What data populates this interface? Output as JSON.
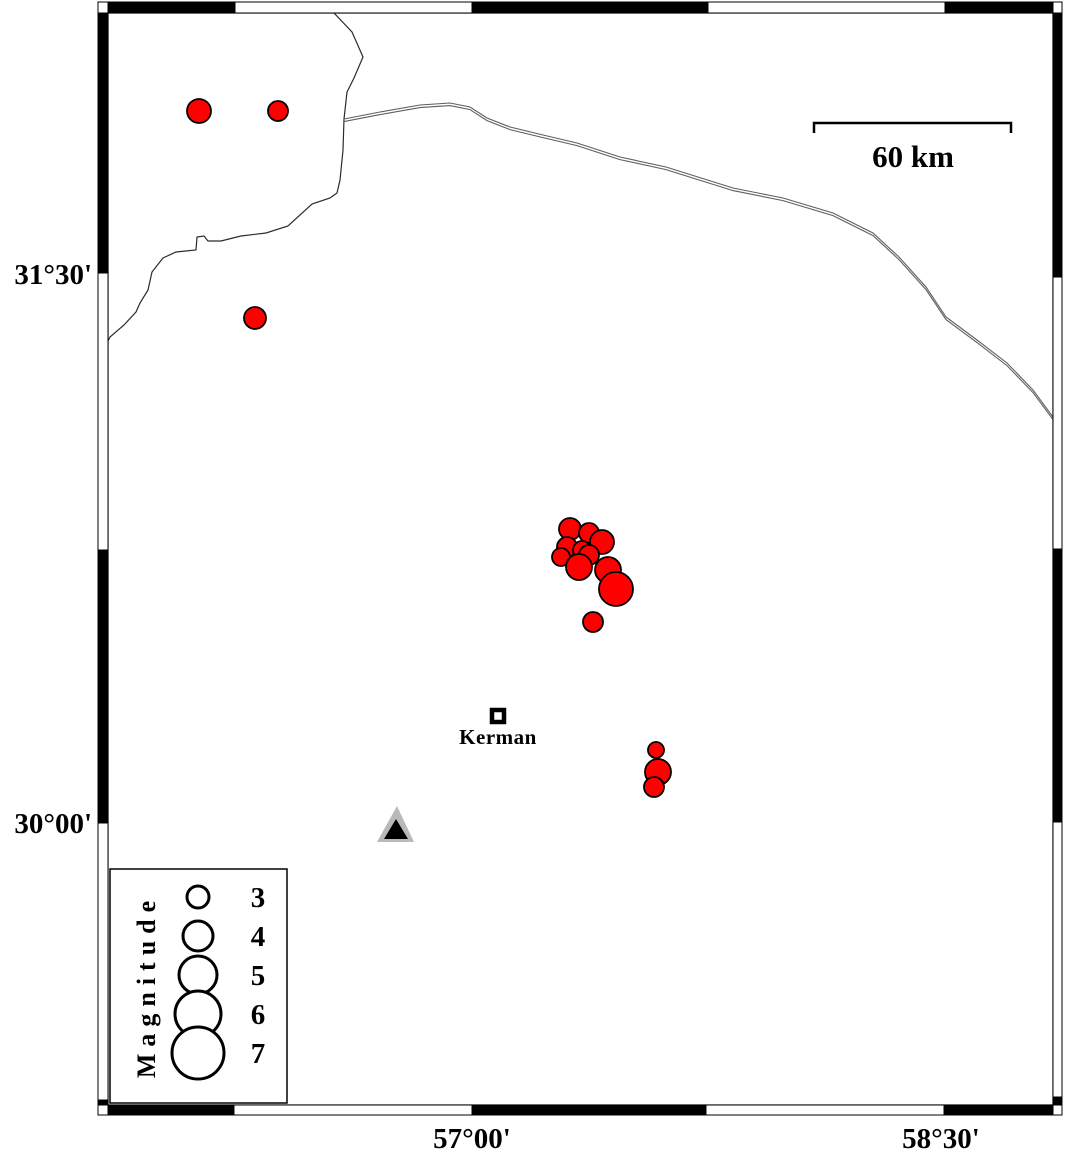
{
  "figure": {
    "width": 1066,
    "height": 1154,
    "background": "#ffffff"
  },
  "map_frame": {
    "inner": {
      "x": 108,
      "y": 13,
      "w": 945,
      "h": 1092
    },
    "bar_thickness": 10,
    "segments": {
      "top": [
        {
          "from": 108,
          "to": 235,
          "color": "black"
        },
        {
          "from": 235,
          "to": 472,
          "color": "white"
        },
        {
          "from": 472,
          "to": 708,
          "color": "black"
        },
        {
          "from": 708,
          "to": 945,
          "color": "white"
        },
        {
          "from": 945,
          "to": 1053,
          "color": "black"
        }
      ],
      "bottom": [
        {
          "from": 108,
          "to": 234,
          "color": "black"
        },
        {
          "from": 234,
          "to": 472,
          "color": "white"
        },
        {
          "from": 472,
          "to": 706,
          "color": "black"
        },
        {
          "from": 706,
          "to": 944,
          "color": "white"
        },
        {
          "from": 944,
          "to": 1053,
          "color": "black"
        }
      ],
      "left": [
        {
          "from": 13,
          "to": 273,
          "color": "black"
        },
        {
          "from": 273,
          "to": 550,
          "color": "white"
        },
        {
          "from": 550,
          "to": 823,
          "color": "black"
        },
        {
          "from": 823,
          "to": 1100,
          "color": "white"
        },
        {
          "from": 1100,
          "to": 1105,
          "color": "black"
        }
      ],
      "right": [
        {
          "from": 13,
          "to": 277,
          "color": "black"
        },
        {
          "from": 277,
          "to": 549,
          "color": "white"
        },
        {
          "from": 549,
          "to": 822,
          "color": "black"
        },
        {
          "from": 822,
          "to": 1097,
          "color": "white"
        },
        {
          "from": 1097,
          "to": 1105,
          "color": "black"
        }
      ]
    }
  },
  "axis_labels": {
    "left": [
      {
        "text": "31°30'",
        "y": 273
      },
      {
        "text": "30°00'",
        "y": 822
      }
    ],
    "bottom": [
      {
        "text": "57°00'",
        "x": 472
      },
      {
        "text": "58°30'",
        "x": 941
      }
    ]
  },
  "scale_bar": {
    "label": "60 km",
    "x1": 814,
    "x2": 1011,
    "y": 123,
    "tick_drop": 10,
    "label_x": 913,
    "label_y": 167
  },
  "city": {
    "name": "Kerman",
    "marker_x": 498,
    "marker_y": 716,
    "label_x": 498,
    "label_y": 744
  },
  "station": {
    "outer_color": "#b9b9b9",
    "inner_color": "#000000",
    "outer": [
      [
        397,
        806
      ],
      [
        377,
        842
      ],
      [
        414,
        842
      ]
    ],
    "inner": [
      [
        396,
        819
      ],
      [
        384,
        839
      ],
      [
        408,
        839
      ]
    ]
  },
  "basemap_lines": {
    "border_color": "#2b2b2b",
    "road_color": "#5f5f5f",
    "border": [
      [
        334,
        13
      ],
      [
        352,
        32
      ],
      [
        363,
        57
      ],
      [
        354,
        78
      ],
      [
        347,
        92
      ],
      [
        344,
        119
      ],
      [
        343,
        150
      ],
      [
        340,
        180
      ],
      [
        337,
        193
      ],
      [
        330,
        198
      ],
      [
        312,
        204
      ],
      [
        288,
        226
      ],
      [
        266,
        233
      ],
      [
        241,
        236
      ],
      [
        221,
        241
      ],
      [
        208,
        241
      ],
      [
        204,
        236
      ],
      [
        197,
        237
      ],
      [
        196,
        250
      ],
      [
        176,
        252
      ],
      [
        163,
        258
      ],
      [
        152,
        272
      ],
      [
        148,
        290
      ],
      [
        140,
        303
      ],
      [
        136,
        312
      ],
      [
        124,
        325
      ],
      [
        110,
        337
      ],
      [
        108,
        341
      ]
    ],
    "road": [
      [
        344,
        119
      ],
      [
        380,
        112
      ],
      [
        420,
        105
      ],
      [
        450,
        103
      ],
      [
        470,
        107
      ],
      [
        487,
        118
      ],
      [
        510,
        127
      ],
      [
        543,
        135
      ],
      [
        577,
        143
      ],
      [
        620,
        157
      ],
      [
        666,
        167
      ],
      [
        733,
        188
      ],
      [
        783,
        198
      ],
      [
        833,
        213
      ],
      [
        873,
        233
      ],
      [
        899,
        257
      ],
      [
        926,
        287
      ],
      [
        946,
        317
      ],
      [
        977,
        340
      ],
      [
        1007,
        363
      ],
      [
        1033,
        390
      ],
      [
        1053,
        417
      ]
    ]
  },
  "earthquakes": {
    "fill": "#ff0000",
    "stroke": "#000000",
    "points": [
      {
        "x": 199,
        "y": 111,
        "r": 12
      },
      {
        "x": 278,
        "y": 111,
        "r": 10
      },
      {
        "x": 255,
        "y": 318,
        "r": 11
      },
      {
        "x": 570,
        "y": 529,
        "r": 11
      },
      {
        "x": 589,
        "y": 533,
        "r": 10
      },
      {
        "x": 602,
        "y": 542,
        "r": 12
      },
      {
        "x": 567,
        "y": 547,
        "r": 10
      },
      {
        "x": 582,
        "y": 550,
        "r": 9
      },
      {
        "x": 561,
        "y": 557,
        "r": 9
      },
      {
        "x": 589,
        "y": 555,
        "r": 10
      },
      {
        "x": 579,
        "y": 567,
        "r": 13
      },
      {
        "x": 608,
        "y": 570,
        "r": 13
      },
      {
        "x": 616,
        "y": 589,
        "r": 17
      },
      {
        "x": 593,
        "y": 622,
        "r": 10
      },
      {
        "x": 656,
        "y": 750,
        "r": 8
      },
      {
        "x": 658,
        "y": 772,
        "r": 13
      },
      {
        "x": 654,
        "y": 787,
        "r": 10
      }
    ]
  },
  "legend": {
    "title": "Magnitude",
    "box": {
      "x": 110,
      "y": 869,
      "w": 177,
      "h": 234
    },
    "circle_x": 198,
    "num_x": 258,
    "entries": [
      {
        "magnitude": "3",
        "y": 897,
        "r": 11
      },
      {
        "magnitude": "4",
        "y": 936,
        "r": 15
      },
      {
        "magnitude": "5",
        "y": 975,
        "r": 19
      },
      {
        "magnitude": "6",
        "y": 1014,
        "r": 23
      },
      {
        "magnitude": "7",
        "y": 1053,
        "r": 26
      }
    ]
  }
}
